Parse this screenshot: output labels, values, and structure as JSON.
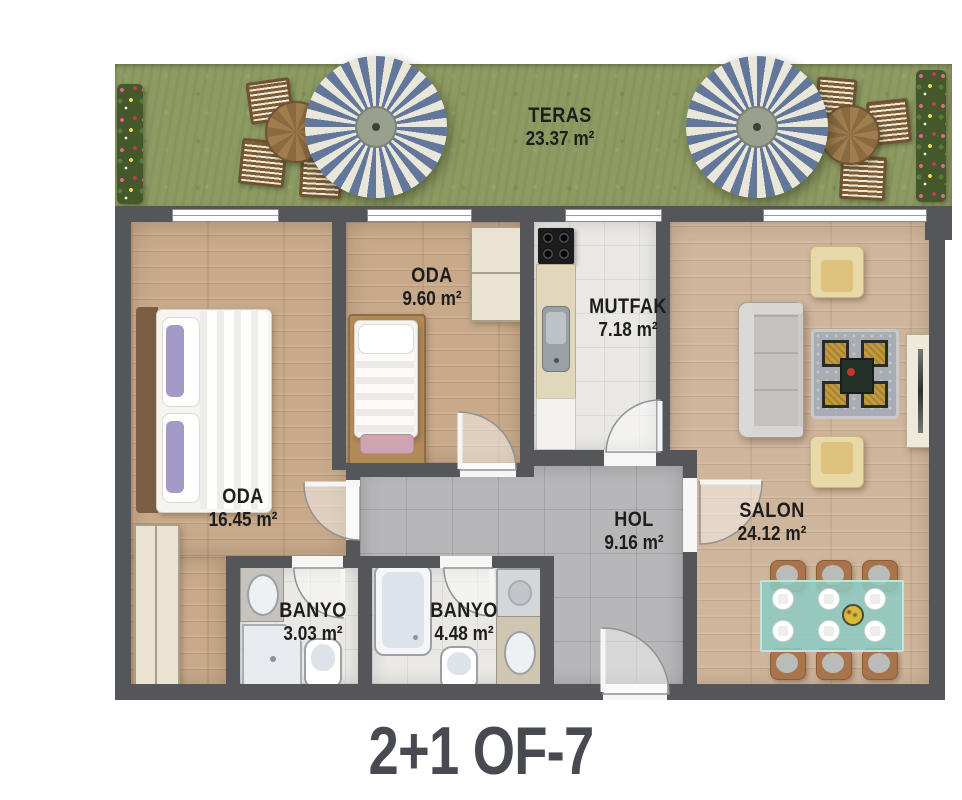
{
  "title": "2+1 OF-7",
  "rooms": {
    "teras": {
      "name": "TERAS",
      "area": "23.37 m²"
    },
    "oda_large": {
      "name": "ODA",
      "area": "16.45 m²"
    },
    "oda_small": {
      "name": "ODA",
      "area": "9.60 m²"
    },
    "mutfak": {
      "name": "MUTFAK",
      "area": "7.18 m²"
    },
    "salon": {
      "name": "SALON",
      "area": "24.12 m²"
    },
    "hol": {
      "name": "HOL",
      "area": "9.16 m²"
    },
    "banyo_small": {
      "name": "BANYO",
      "area": "3.03 m²"
    },
    "banyo_large": {
      "name": "BANYO",
      "area": "4.48 m²"
    }
  },
  "colors": {
    "wall": "#55565a",
    "wood_floor": "#c8aa8b",
    "wood_floor_salon": "#cfb59c",
    "tile_gray": "#b7b7b9",
    "tile_white": "#e9e8e4",
    "grass": "#8d9b63",
    "umbrella_stripe": "#63779b",
    "umbrella_light": "#e9e6da",
    "label_text": "#1d1d1b",
    "title_text": "#474b51"
  }
}
